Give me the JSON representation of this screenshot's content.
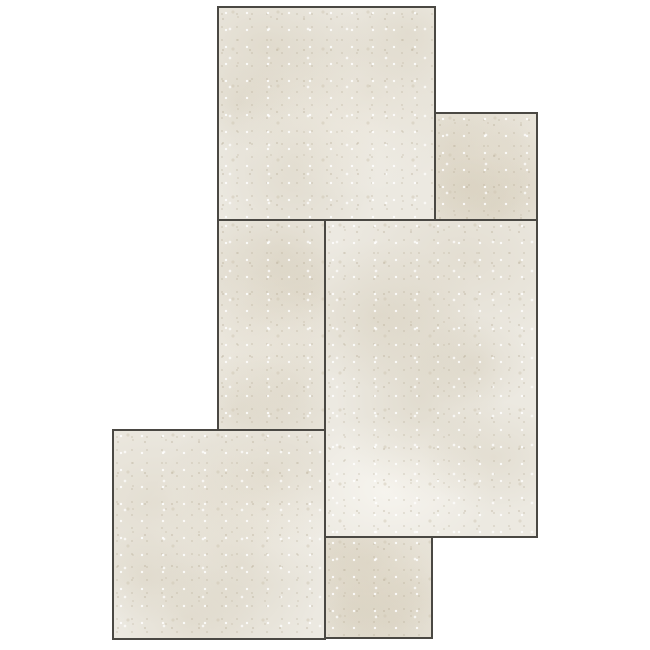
{
  "canvas": {
    "width_px": 650,
    "height_px": 650,
    "background_color": "#ffffff"
  },
  "pattern": {
    "name": "modular-stone-tile-layout",
    "tile_count": 6,
    "grout_border_color": "#4a4843",
    "stone_base_color": "#ece9e1",
    "stone_mottle_color": "#d5ccba",
    "stone_speckle_dark_color": "#ada18a",
    "stone_speckle_light_color": "#ffffff",
    "tiles": [
      {
        "id": "tile-1",
        "shape": "large-square",
        "position": "top-left"
      },
      {
        "id": "tile-2",
        "shape": "small-square",
        "position": "top-right"
      },
      {
        "id": "tile-3",
        "shape": "vertical-rectangle",
        "position": "middle-left"
      },
      {
        "id": "tile-4",
        "shape": "large-vertical-rectangle",
        "position": "middle-right"
      },
      {
        "id": "tile-5",
        "shape": "large-square",
        "position": "bottom-left"
      },
      {
        "id": "tile-6",
        "shape": "small-square",
        "position": "bottom-center"
      }
    ]
  }
}
